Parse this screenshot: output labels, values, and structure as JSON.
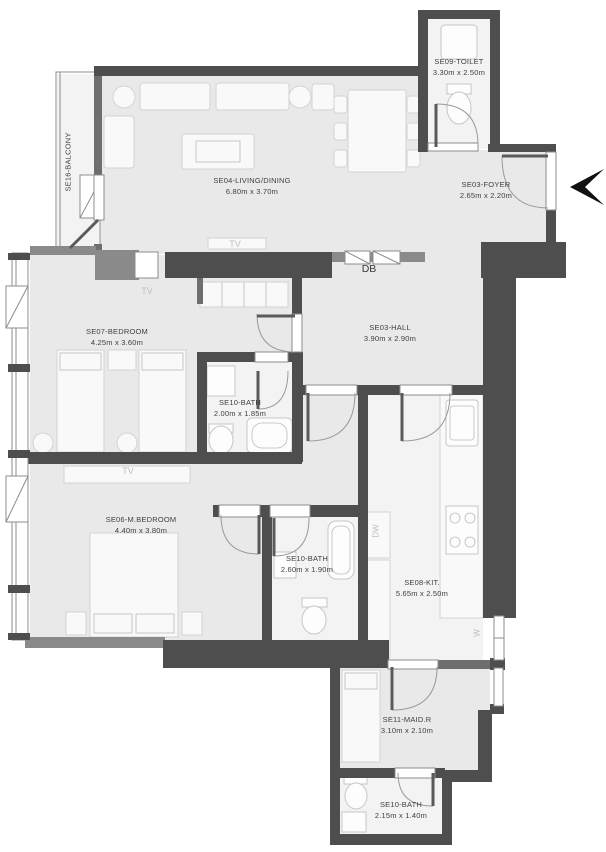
{
  "title": "Apartment unit floor plan",
  "colors": {
    "wall": "#4e4e4e",
    "wall_medium": "#8a8a8a",
    "wall_soft": "#6e6e6e",
    "floor": "#e9e9e9",
    "floor_bright": "#f3f3f3",
    "furniture": "#f9f9f9",
    "furniture_line": "#d4d4d4",
    "frame_line": "#8c8c8c",
    "door_line": "#9a9a9a",
    "leaf": "#5a5a5a",
    "text": "#3f3f3f",
    "muted_text": "#bdbdbd",
    "arrow": "#111111"
  },
  "rooms": [
    {
      "id": "balcony",
      "name": "SE16-BALCONY",
      "dims": ""
    },
    {
      "id": "living-dining",
      "name": "SE04-LIVING/DINING",
      "dims": "6.80m x 3.70m"
    },
    {
      "id": "toilet",
      "name": "SE09-TOILET",
      "dims": "3.30m x 2.50m"
    },
    {
      "id": "foyer",
      "name": "SE03-FOYER",
      "dims": "2.65m x 2.20m"
    },
    {
      "id": "bedroom",
      "name": "SE07-BEDROOM",
      "dims": "4.25m x 3.60m"
    },
    {
      "id": "hall",
      "name": "SE03-HALL",
      "dims": "3.90m x 2.90m"
    },
    {
      "id": "bath-1",
      "name": "SE10-BATH",
      "dims": "2.00m x 1.85m"
    },
    {
      "id": "master-bedroom",
      "name": "SE06-M.BEDROOM",
      "dims": "4.40m x 3.80m"
    },
    {
      "id": "bath-2",
      "name": "SE10-BATH",
      "dims": "2.60m x 1.90m"
    },
    {
      "id": "kitchen",
      "name": "SE08-KIT.",
      "dims": "5.65m x 2.50m"
    },
    {
      "id": "maid-room",
      "name": "SE11-MAID.R",
      "dims": "3.10m x 2.10m"
    },
    {
      "id": "bath-3",
      "name": "SE10-BATH",
      "dims": "2.15m x 1.40m"
    }
  ],
  "annotations": {
    "db": "DB",
    "tv": "TV",
    "dw": "DW",
    "w": "W"
  },
  "entrance": {
    "symbol": "arrow",
    "direction": "left"
  }
}
